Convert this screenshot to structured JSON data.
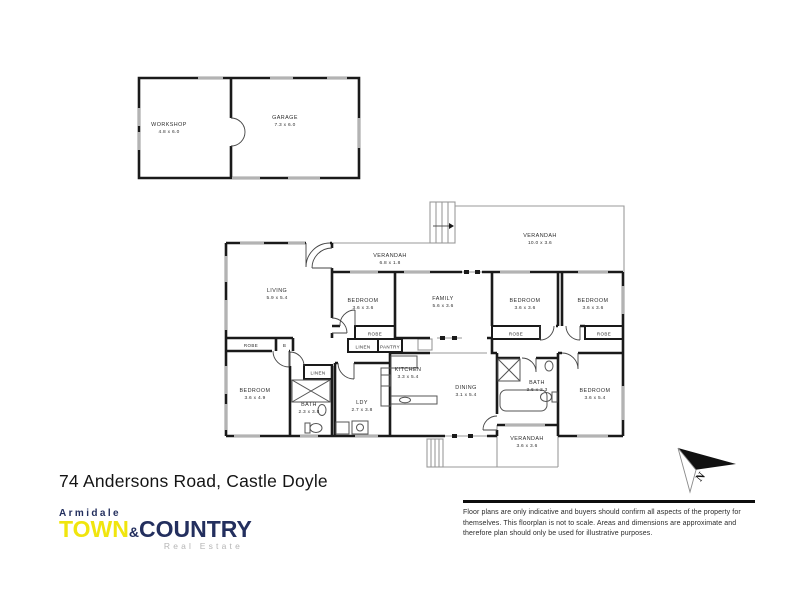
{
  "address": "74 Andersons Road, Castle Doyle",
  "logo": {
    "region": "Armidale",
    "town": "TOWN",
    "ampersand": "&",
    "country": "COUNTRY",
    "tagline": "Real Estate"
  },
  "disclaimer": "Floor plans are only indicative and buyers should confirm all aspects of the property for themselves. This floorplan is not to scale. Areas and dimensions are approximate and therefore plan should only be used for illustrative purposes.",
  "compass": {
    "label": "N"
  },
  "colors": {
    "navy": "#232f5e",
    "yellow": "#f0e50e",
    "tagline_gray": "#b5b5b5",
    "wall_black": "#1a1a1a",
    "window_gray": "#b3b3b3"
  },
  "rooms": {
    "workshop": {
      "name": "WORKSHOP",
      "dims": "4.8 x 6.0"
    },
    "garage": {
      "name": "GARAGE",
      "dims": "7.3 x 6.0"
    },
    "living": {
      "name": "LIVING",
      "dims": "5.9 x 5.4"
    },
    "verandah_left": {
      "name": "VERANDAH",
      "dims": "6.8 x 1.8"
    },
    "verandah_top": {
      "name": "VERANDAH",
      "dims": "10.0 x 3.6"
    },
    "bedroom1": {
      "name": "BEDROOM",
      "dims": "3.6 x 3.6"
    },
    "family": {
      "name": "FAMILY",
      "dims": "5.6 x 3.6"
    },
    "bedroom2": {
      "name": "BEDROOM",
      "dims": "3.6 x 3.6"
    },
    "bedroom3": {
      "name": "BEDROOM",
      "dims": "3.6 x 3.6"
    },
    "bedroom4": {
      "name": "BEDROOM",
      "dims": "3.6 x 4.9"
    },
    "bath1": {
      "name": "BATH",
      "dims": "2.3 x 3.8"
    },
    "ldy": {
      "name": "LDY",
      "dims": "2.7 x 3.8"
    },
    "kitchen": {
      "name": "KITCHEN",
      "dims": "3.3 x 5.4"
    },
    "dining": {
      "name": "DINING",
      "dims": "3.1 x 5.4"
    },
    "bath2": {
      "name": "BATH",
      "dims": "3.6 x 2.3"
    },
    "bedroom5": {
      "name": "BEDROOM",
      "dims": "3.6 x 5.4"
    },
    "verandah_bottom": {
      "name": "VERANDAH",
      "dims": "3.6 x 3.6"
    },
    "robe_hall": {
      "name": "ROBE"
    },
    "b_closet": {
      "name": "B"
    },
    "robe1": {
      "name": "ROBE"
    },
    "robe2": {
      "name": "ROBE"
    },
    "robe3": {
      "name": "ROBE"
    },
    "linen_hall": {
      "name": "LINEN"
    },
    "pantry": {
      "name": "PANTRY"
    },
    "linen_bath": {
      "name": "LINEN"
    }
  }
}
